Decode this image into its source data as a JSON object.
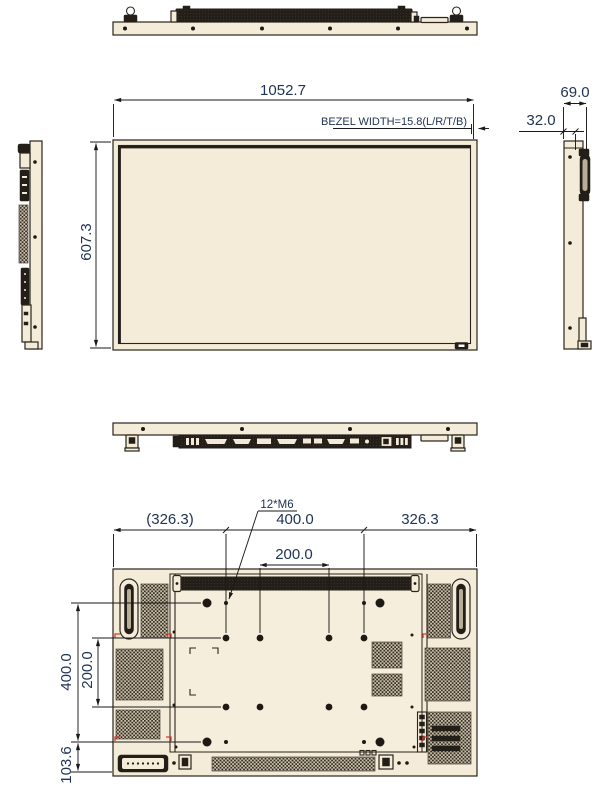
{
  "drawing": {
    "type": "display-mechanical-dimension-drawing",
    "front": {
      "width_mm": "1052.7",
      "height_mm": "607.3",
      "bezel_note": "BEZEL WIDTH=15.8(L/R/T/B)"
    },
    "side": {
      "depth_total_mm": "69.0",
      "depth_body_mm": "32.0"
    },
    "rear": {
      "offset_left": "(326.3)",
      "vesa_width": "400.0",
      "offset_right": "326.3",
      "vesa_width_inner": "200.0",
      "screw_spec": "12*M6",
      "vesa_height": "400.0",
      "vesa_height_inner": "200.0",
      "bottom_offset": "103.6"
    },
    "colors": {
      "body": "#f4ebd9",
      "line": "#2a241c",
      "dimension_text": "#203455",
      "registration_mark": "#d93a2b"
    }
  }
}
